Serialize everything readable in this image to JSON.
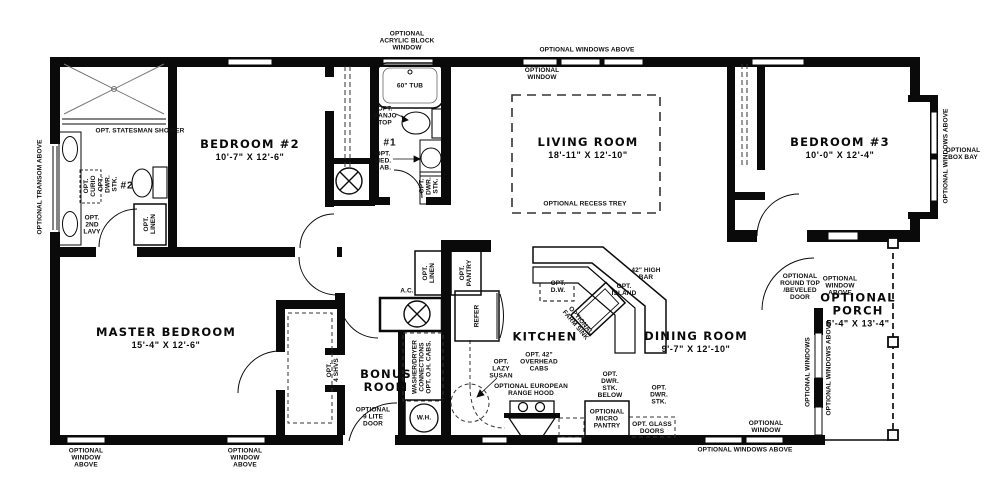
{
  "colors": {
    "wall": "#0a0a0a",
    "background": "#ffffff",
    "text": "#111111",
    "dash": "#333333"
  },
  "rooms": [
    {
      "id": "bedroom-2",
      "lines": [
        "BEDROOM #2"
      ],
      "dims": "10'-7\" X 12'-6\"",
      "x": 250,
      "y": 150
    },
    {
      "id": "living-room",
      "lines": [
        "LIVING ROOM"
      ],
      "dims": "18'-11\" X 12'-10\"",
      "x": 588,
      "y": 148
    },
    {
      "id": "bedroom-3",
      "lines": [
        "BEDROOM #3"
      ],
      "dims": "10'-0\" X 12'-4\"",
      "x": 840,
      "y": 148
    },
    {
      "id": "master-bedroom",
      "lines": [
        "MASTER BEDROOM"
      ],
      "dims": "15'-4\" X 12'-6\"",
      "x": 166,
      "y": 338
    },
    {
      "id": "kitchen",
      "lines": [
        "KITCHEN"
      ],
      "dims": "",
      "x": 545,
      "y": 337
    },
    {
      "id": "dining-room",
      "lines": [
        "DINING ROOM"
      ],
      "dims": "9'-7\" X 12'-10\"",
      "x": 696,
      "y": 342
    },
    {
      "id": "bonus-room",
      "lines": [
        "BONUS",
        "ROOM"
      ],
      "dims": "",
      "x": 386,
      "y": 381
    },
    {
      "id": "optional-porch",
      "lines": [
        "OPTIONAL",
        "PORCH"
      ],
      "dims": "5'-4\" X 13'-4\"",
      "x": 858,
      "y": 310
    }
  ],
  "annotations": [
    {
      "name": "optional-transom-above",
      "lines": [
        "OPTIONAL TRANSOM ABOVE"
      ],
      "x": 40,
      "y": 187,
      "rot": -90
    },
    {
      "name": "opt-statesman-shower",
      "lines": [
        "OPT. STATESMAN SHOWER"
      ],
      "x": 140,
      "y": 131
    },
    {
      "name": "opt-curio",
      "lines": [
        "OPT.",
        "CURIO"
      ],
      "x": 90,
      "y": 186,
      "rot": -90
    },
    {
      "name": "opt-dwr-stk-bath2",
      "lines": [
        "OPT.",
        "DWR.",
        "STK."
      ],
      "x": 108,
      "y": 184,
      "rot": -90
    },
    {
      "name": "bath-2-number",
      "lines": [
        "#2"
      ],
      "x": 127,
      "y": 187,
      "cls": "num"
    },
    {
      "name": "opt-2nd-lavy",
      "lines": [
        "OPT.",
        "2ND",
        "LAVY"
      ],
      "x": 92,
      "y": 225
    },
    {
      "name": "opt-linen-bath2",
      "lines": [
        "OPT.",
        "LINEN"
      ],
      "x": 150,
      "y": 224,
      "rot": -90
    },
    {
      "name": "optional-acrylic-block-window",
      "lines": [
        "OPTIONAL",
        "ACRYLIC BLOCK",
        "WINDOW"
      ],
      "x": 407,
      "y": 41
    },
    {
      "name": "optional-windows-above-top",
      "lines": [
        "OPTIONAL WINDOWS ABOVE"
      ],
      "x": 587,
      "y": 50
    },
    {
      "name": "optional-window-living",
      "lines": [
        "OPTIONAL",
        "WINDOW"
      ],
      "x": 542,
      "y": 74
    },
    {
      "name": "tub-label",
      "lines": [
        "60\" TUB"
      ],
      "x": 410,
      "y": 86
    },
    {
      "name": "opt-banjo-top",
      "lines": [
        "OPT.",
        "BANJO",
        "TOP"
      ],
      "x": 385,
      "y": 116
    },
    {
      "name": "bath-1-number",
      "lines": [
        "#1"
      ],
      "x": 390,
      "y": 144,
      "cls": "num"
    },
    {
      "name": "opt-med-cab",
      "lines": [
        "OPT.",
        "MED.",
        "CAB."
      ],
      "x": 383,
      "y": 161
    },
    {
      "name": "opt-dwr-stk-bath1",
      "lines": [
        "OPT.",
        "DWR.",
        "STK."
      ],
      "x": 429,
      "y": 186,
      "rot": -90
    },
    {
      "name": "optional-windows-above-bay",
      "lines": [
        "OPTIONAL WINDOWS ABOVE"
      ],
      "x": 946,
      "y": 156,
      "rot": -90
    },
    {
      "name": "optional-box-bay",
      "lines": [
        "OPTIONAL",
        "BOX BAY"
      ],
      "x": 963,
      "y": 154
    },
    {
      "name": "optional-recess-trey",
      "lines": [
        "OPTIONAL RECESS TREY"
      ],
      "x": 585,
      "y": 204
    },
    {
      "name": "ac-label",
      "lines": [
        "A.C."
      ],
      "x": 407,
      "y": 291
    },
    {
      "name": "opt-linen-hall",
      "lines": [
        "OPT.",
        "LINEN"
      ],
      "x": 429,
      "y": 273,
      "rot": -90
    },
    {
      "name": "opt-pantry",
      "lines": [
        "OPT.",
        "PANTRY"
      ],
      "x": 466,
      "y": 273,
      "rot": -90
    },
    {
      "name": "refer-label",
      "lines": [
        "REFER"
      ],
      "x": 477,
      "y": 316,
      "rot": -90
    },
    {
      "name": "washer-dryer-connections",
      "lines": [
        "WASHER/DRYER",
        "CONNECTIONS",
        "OPT. O.H. CABS."
      ],
      "x": 422,
      "y": 367,
      "rot": -90
    },
    {
      "name": "wh-label",
      "lines": [
        "W.H."
      ],
      "x": 424,
      "y": 418
    },
    {
      "name": "optional-9-lite-door",
      "lines": [
        "OPTIONAL",
        "9 LITE",
        "DOOR"
      ],
      "x": 373,
      "y": 417
    },
    {
      "name": "opt-lazy-susan",
      "lines": [
        "OPT.",
        "LAZY",
        "SUSAN"
      ],
      "x": 501,
      "y": 369
    },
    {
      "name": "opt-42-overhead-cabs",
      "lines": [
        "OPT. 42\"",
        "OVERHEAD",
        "CABS"
      ],
      "x": 539,
      "y": 362
    },
    {
      "name": "optional-european-range-hood",
      "lines": [
        "OPTIONAL EUROPEAN",
        "RANGE HOOD"
      ],
      "x": 531,
      "y": 390
    },
    {
      "name": "opt-dw",
      "lines": [
        "OPT.",
        "D.W."
      ],
      "x": 558,
      "y": 287
    },
    {
      "name": "42-high-bar",
      "lines": [
        "42\" HIGH",
        "BAR"
      ],
      "x": 646,
      "y": 274
    },
    {
      "name": "opt-island",
      "lines": [
        "OPT.",
        "ISLAND"
      ],
      "x": 624,
      "y": 290
    },
    {
      "name": "optional-farm-sink",
      "lines": [
        "OPTIONAL",
        "FARM SINK"
      ],
      "x": 578,
      "y": 323,
      "rot": 50
    },
    {
      "name": "opt-dwr-stk-below",
      "lines": [
        "OPT.",
        "DWR.",
        "STK.",
        "BELOW"
      ],
      "x": 610,
      "y": 385
    },
    {
      "name": "optional-micro-pantry",
      "lines": [
        "OPTIONAL",
        "MICRO",
        "PANTRY"
      ],
      "x": 607,
      "y": 419
    },
    {
      "name": "opt-dwr-stk-dining",
      "lines": [
        "OPT.",
        "DWR.",
        "STK."
      ],
      "x": 659,
      "y": 395
    },
    {
      "name": "opt-glass-doors",
      "lines": [
        "OPT. GLASS",
        "DOORS"
      ],
      "x": 652,
      "y": 428
    },
    {
      "name": "optional-round-top-beveled-door",
      "lines": [
        "OPTIONAL",
        "ROUND TOP",
        "/BEVELED",
        "DOOR"
      ],
      "x": 800,
      "y": 287
    },
    {
      "name": "optional-window-above-porch",
      "lines": [
        "OPTIONAL",
        "WINDOW",
        "ABOVE"
      ],
      "x": 840,
      "y": 286
    },
    {
      "name": "optional-windows-dining",
      "lines": [
        "OPTIONAL WINDOWS"
      ],
      "x": 808,
      "y": 372,
      "rot": -90
    },
    {
      "name": "optional-windows-above-porch-side",
      "lines": [
        "OPTIONAL WINDOWS ABOVE"
      ],
      "x": 829,
      "y": 368,
      "rot": -90
    },
    {
      "name": "optional-window-above-left-1",
      "lines": [
        "OPTIONAL",
        "WINDOW",
        "ABOVE"
      ],
      "x": 86,
      "y": 458
    },
    {
      "name": "optional-window-above-left-2",
      "lines": [
        "OPTIONAL",
        "WINDOW",
        "ABOVE"
      ],
      "x": 245,
      "y": 458
    },
    {
      "name": "optional-window-dining-bottom",
      "lines": [
        "OPTIONAL",
        "WINDOW"
      ],
      "x": 766,
      "y": 427
    },
    {
      "name": "optional-windows-above-bottom",
      "lines": [
        "OPTIONAL WINDOWS ABOVE"
      ],
      "x": 745,
      "y": 450
    },
    {
      "name": "opt-4-shvs",
      "lines": [
        "OPT.",
        "4 SHVS"
      ],
      "x": 333,
      "y": 370,
      "rot": -90
    }
  ]
}
